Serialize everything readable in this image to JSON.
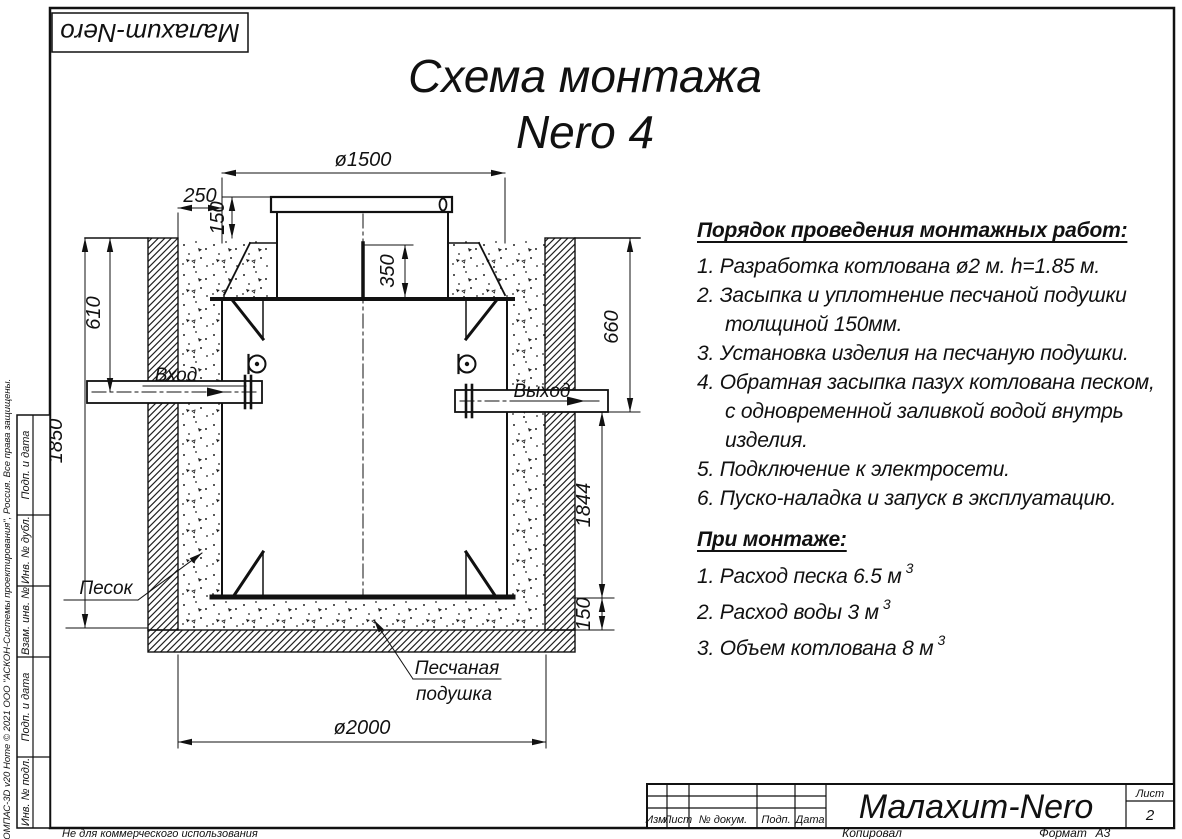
{
  "logo": "Малахит-Nero",
  "title": {
    "line1": "Схема монтажа",
    "line2": "Nero 4"
  },
  "drawing": {
    "dims": {
      "d1500": "ø1500",
      "d250": "250",
      "d150_top": "150",
      "d350": "350",
      "d610": "610",
      "d1850": "1850",
      "d660": "660",
      "d1844": "1844",
      "d150_bottom": "150",
      "d2000": "ø2000"
    },
    "labels": {
      "inlet": "Вход",
      "outlet": "Выход",
      "sand": "Песок",
      "sand_pad_line1": "Песчаная",
      "sand_pad_line2": "подушка"
    }
  },
  "sections": {
    "order": {
      "heading": "Порядок проведения монтажных работ:",
      "items": [
        "1. Разработка котлована ø2 м. h=1.85 м.",
        "2. Засыпка и уплотнение песчаной подушки",
        "толщиной 150мм.",
        "3. Установка изделия на песчаную подушки.",
        "4. Обратная засыпка пазух котлована песком,",
        "с одновременной заливкой водой внутрь",
        "изделия.",
        "5. Подключение к электросети.",
        "6. Пуско-наладка и запуск в эксплуатацию."
      ]
    },
    "montage": {
      "heading": "При монтаже:",
      "items": [
        {
          "text": "1. Расход песка 6.5 м",
          "sup": "3"
        },
        {
          "text": "2. Расход воды 3 м",
          "sup": "3"
        },
        {
          "text": "3. Объем котлована 8 м",
          "sup": "3"
        }
      ]
    }
  },
  "title_block": {
    "columns": [
      "Изм.",
      "Лист",
      "№ докум.",
      "Подп.",
      "Дата"
    ],
    "name": "Малахит-Nero",
    "sheet_label": "Лист",
    "sheet_number": "2",
    "copied": "Копировал",
    "format_label": "Формат",
    "format_value": "А3"
  },
  "side_strip": {
    "cells": [
      "Подп. и дата",
      "Инв. № дубл.",
      "Взам. инв. №",
      "Подп. и дата",
      "Инв. № подл."
    ],
    "copyright": "КОМПАС-3D v20 Home © 2021 ООО \"АСКОН-Системы проектирования\", Россия. Все права защищены.",
    "not_commercial": "Не для коммерческого использования"
  }
}
